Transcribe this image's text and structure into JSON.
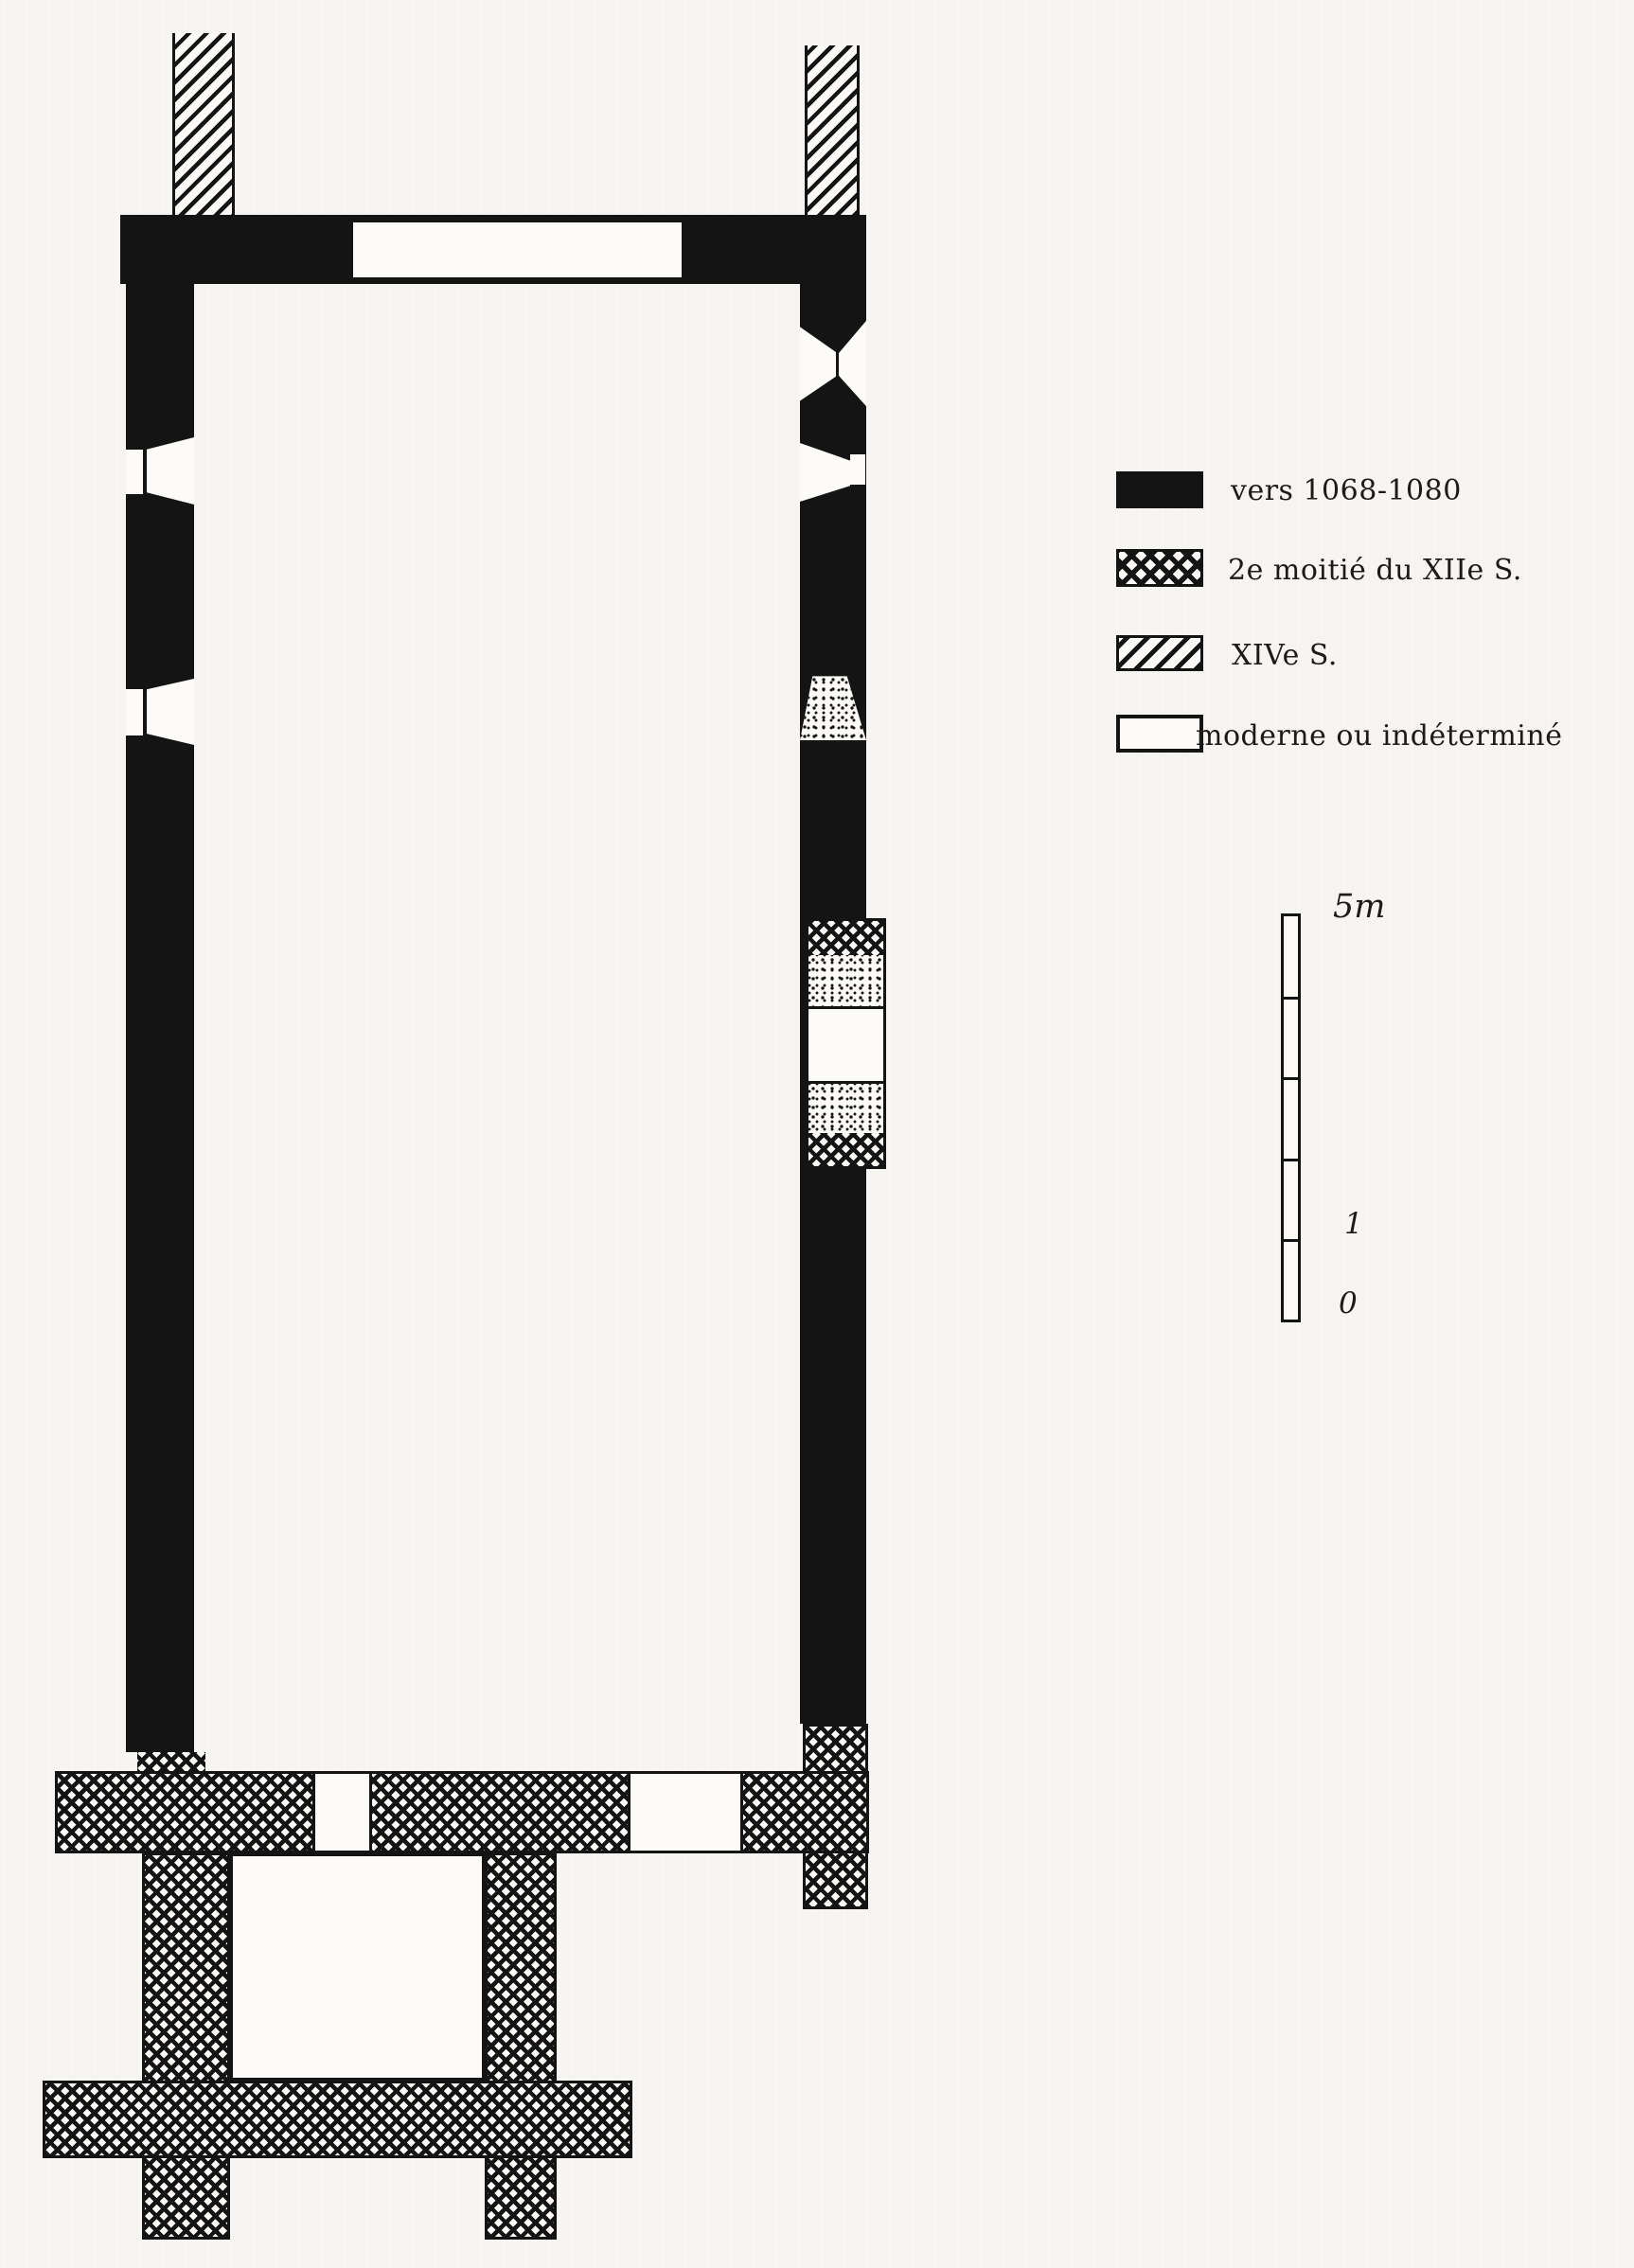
{
  "colors": {
    "ink": "#141414",
    "paper": "#f6f5f1"
  },
  "legend": {
    "items": [
      {
        "id": "period-1068-1080",
        "pattern": "solid-black",
        "label": "vers 1068-1080"
      },
      {
        "id": "period-xii-2",
        "pattern": "crosshatch",
        "label": "2e moitié du XIIe S."
      },
      {
        "id": "period-xiv",
        "pattern": "diagonal-hatch",
        "label": "XIVe S."
      },
      {
        "id": "modern",
        "pattern": "white-outline",
        "label": "moderne ou indéterminé"
      }
    ]
  },
  "scale_bar": {
    "segments": 5,
    "label_top": "5m",
    "label_one": "1",
    "label_zero": "0"
  }
}
